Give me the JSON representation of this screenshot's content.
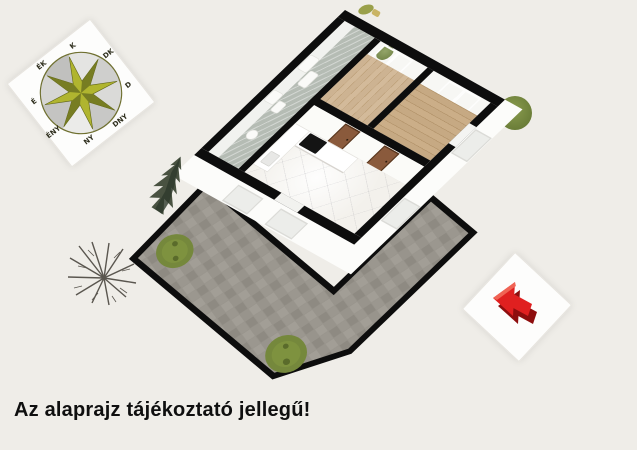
{
  "background_color": "#efede8",
  "caption": {
    "text": "Az alaprajz tájékoztató jellegű!",
    "color": "#0f0f0f"
  },
  "compass": {
    "labels": [
      "É",
      "ÉK",
      "K",
      "DK",
      "D",
      "DNY",
      "NY",
      "ÉNY"
    ],
    "star_color": "#b0b52f",
    "star_shade_color": "#6e7420",
    "ring_color": "#6f7030"
  },
  "floorplan": {
    "wall_color": "#0d0d0d",
    "exterior_color": "#fcfcfa",
    "floor_colors": {
      "bedroom_top": "#cbb28f",
      "bedroom_right": "#c2a57d",
      "bathroom": "#b5bcb4",
      "living_kitchen_marble": "#f3f1ec",
      "terrace_paving": "#98948c"
    },
    "door_color": "#8a5a3c",
    "kitchen_counter_color": "#ffffff",
    "cooktop_color": "#141414",
    "vegetation_color": "#75883c"
  },
  "direction_arrow": {
    "color": "#e02020",
    "shade_color": "#8e0e0e"
  }
}
